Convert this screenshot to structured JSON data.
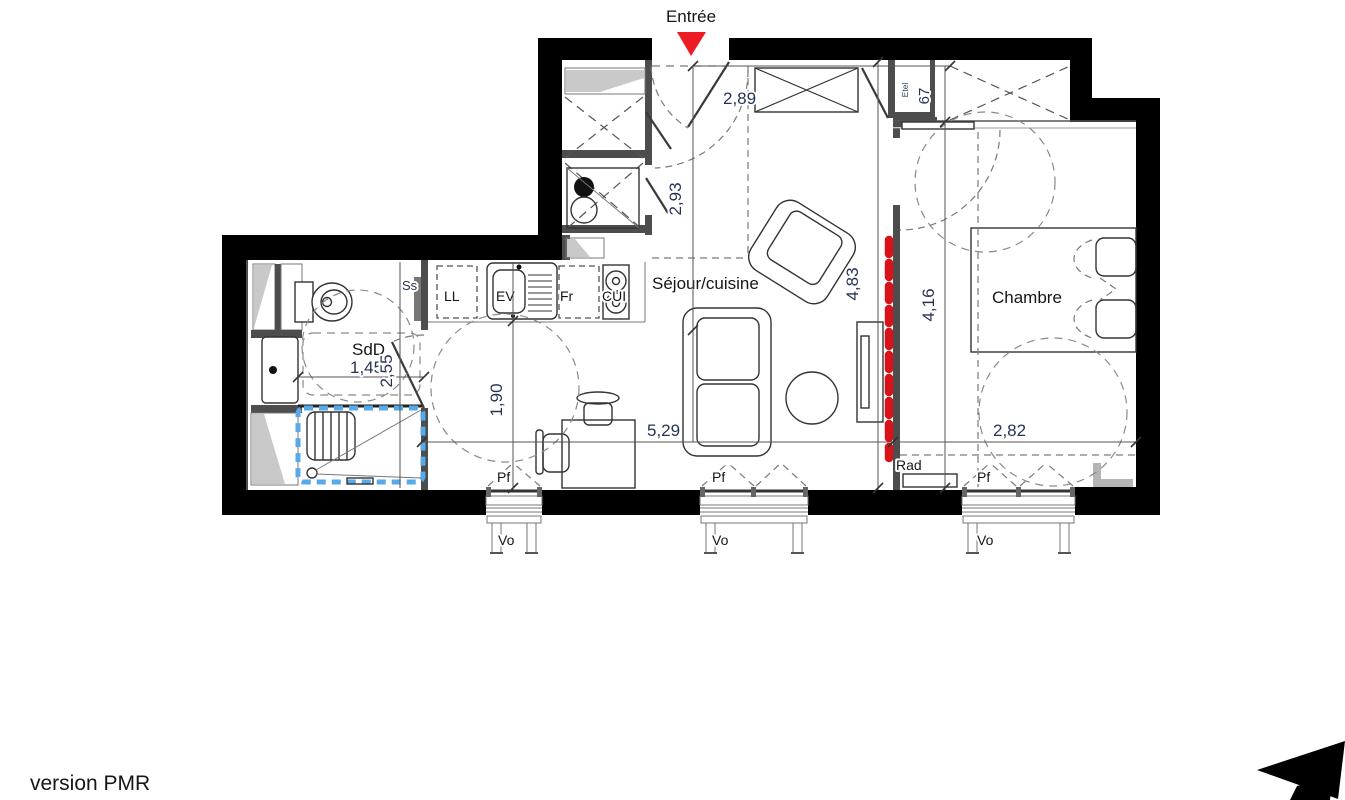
{
  "footer": {
    "version_label": "version PMR"
  },
  "entrance": {
    "label": "Entrée"
  },
  "rooms": {
    "living_kitchen": "Séjour/cuisine",
    "bedroom": "Chambre",
    "shower_room": "SdD"
  },
  "equipment": {
    "washing_machine": "LL",
    "sink": "EV",
    "fridge": "Fr",
    "cooktop": "CUI",
    "towel_dryer": "Ss",
    "radiator": "Rad",
    "electrical_panel": "Etel"
  },
  "openings": {
    "french_window": "Pf",
    "roller_shutter": "Vo"
  },
  "dimensions": {
    "entry_width": "2,89",
    "entry_depth": "2,93",
    "closet_depth_cm": "67",
    "living_length": "4,83",
    "bedroom_length": "4,16",
    "bedroom_width": "2,82",
    "living_width": "5,29",
    "kitchen_clearance": "1,90",
    "shower_room_width": "1,45",
    "shower_room_length": "2,55"
  },
  "colors": {
    "wall": "#000000",
    "partition": "#4d4d4d",
    "accent_red": "#e8191f",
    "shower_blue": "#57a9e8",
    "dimension_text": "#253455"
  }
}
